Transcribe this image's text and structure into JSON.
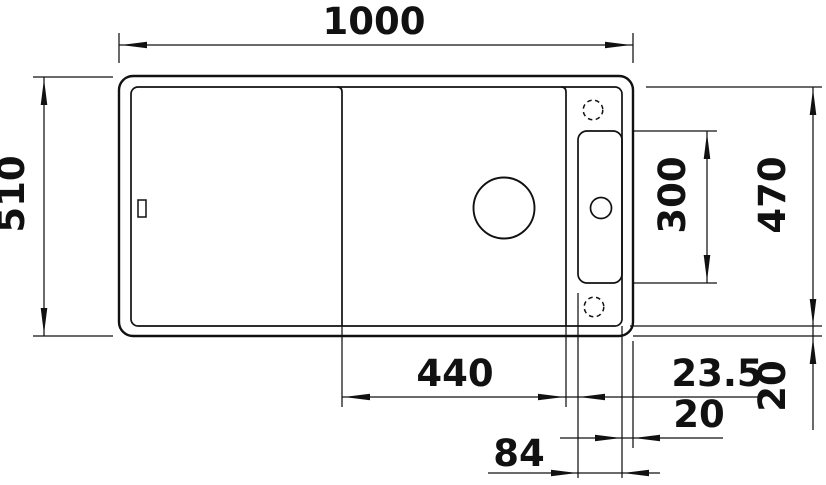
{
  "drawing": {
    "type": "technical-dimension-drawing",
    "subject": "kitchen sink top view with drainboard, bowl and accessory rail",
    "units": "mm",
    "colors": {
      "line": "#111111",
      "background": "#ffffff"
    },
    "dimensions": {
      "overall_width": "1000",
      "overall_depth": "510",
      "inner_depth": "470",
      "rail_length": "300",
      "bowl_section_width": "440",
      "bowl_to_rail_offset": "23.5",
      "rim_offset_horizontal": "20",
      "rail_width": "84",
      "rim_offset_vertical": "20"
    },
    "features": [
      "sink-outline",
      "sink-inner-rim",
      "drainboard-divider",
      "bowl-divider",
      "accessory-rail",
      "drain-hole",
      "tap-hole",
      "optional-tap-hole-top",
      "optional-tap-hole-bottom",
      "cutting-board-slot"
    ]
  }
}
